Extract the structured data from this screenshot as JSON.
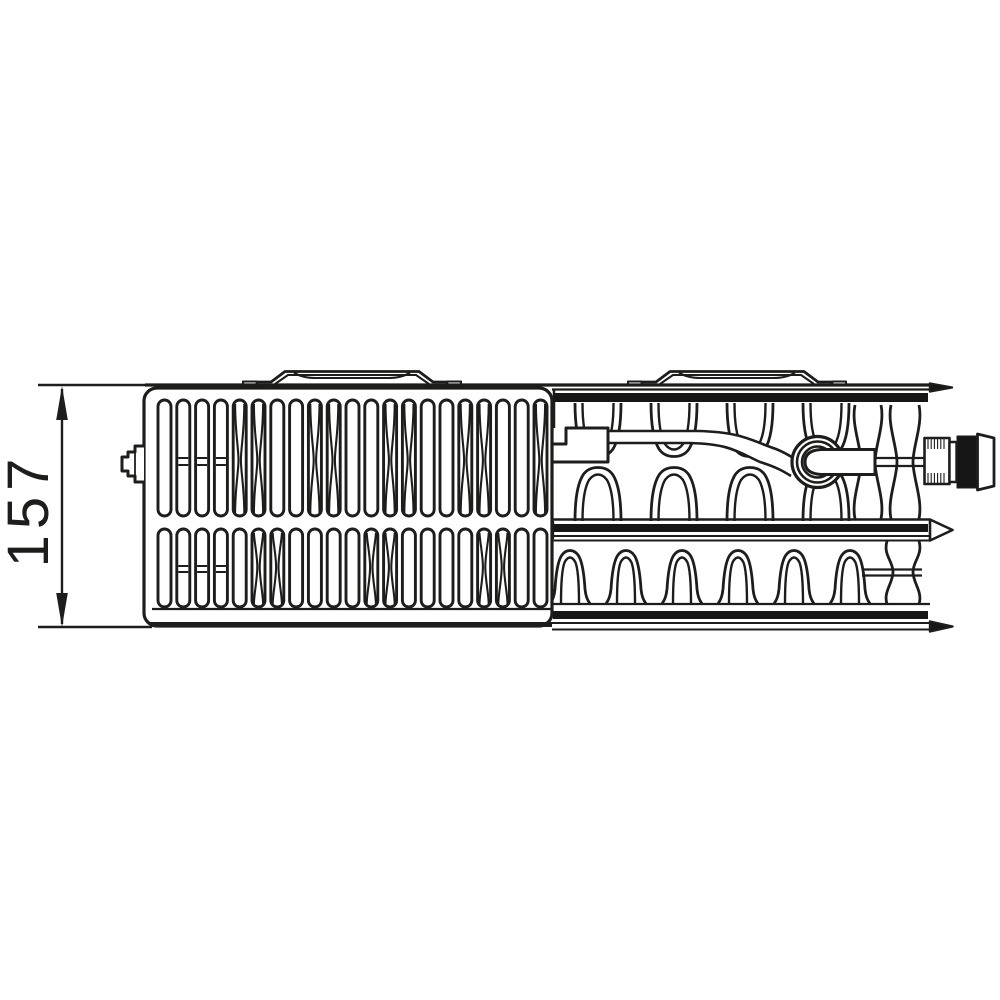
{
  "colors": {
    "line": "#1d1d1b",
    "dark_fill": "#161616",
    "background": "#ffffff"
  },
  "dimension": {
    "label": "157"
  },
  "drawing": {
    "tabs": {
      "centers": [
        352,
        737
      ]
    },
    "grille": {
      "x0": 158,
      "pitch": 18.8,
      "count": 21,
      "slot_w": 13,
      "row1": {
        "y": 400,
        "h": 116,
        "pinch_y": 460,
        "hourglass": [
          4,
          5,
          8,
          9,
          12,
          13,
          16,
          17,
          20
        ],
        "rungs": [
          1,
          2,
          3
        ],
        "rung_ys": [
          458,
          465
        ]
      },
      "row2": {
        "y": 529,
        "h": 78,
        "pinch_y": 567,
        "hourglass": [
          5,
          6,
          11,
          12,
          17,
          18
        ],
        "rungs": [
          1,
          2,
          3
        ],
        "rung_ys": [
          566,
          572
        ]
      }
    },
    "fins": {
      "upper_down_centers": [
        598,
        674,
        750,
        826
      ],
      "upper_up_centers": [
        598,
        674,
        750,
        826
      ],
      "lower_centers": [
        570,
        626,
        682,
        738,
        794,
        850
      ],
      "channels_upper": [
        [
          852,
          884
        ],
        [
          888,
          922
        ]
      ],
      "channel_lower": [
        884,
        922
      ]
    },
    "valve": {
      "cx": 817.5,
      "cy": 462,
      "radii": [
        25.5,
        20.5,
        15.5
      ]
    }
  }
}
